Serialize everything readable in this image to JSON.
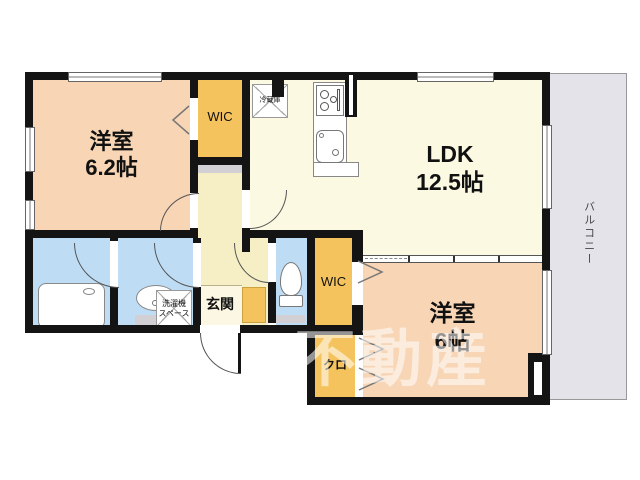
{
  "colors": {
    "wall": "#141414",
    "room-peach": "#f7d5b5",
    "room-orange": "#f5c35e",
    "room-cream": "#fbf9e2",
    "room-pale": "#f6efc6",
    "room-genkan": "#fbf7e3",
    "room-blue": "#bedcf3",
    "balcony-gray": "#e4e3ea",
    "shelf-gray": "#d2cfd5"
  },
  "labels": {
    "bedroom1": {
      "name": "洋室",
      "size": "6.2帖"
    },
    "ldk": {
      "name": "LDK",
      "size": "12.5帖"
    },
    "bedroom2": {
      "name": "洋室",
      "size": "6帖"
    },
    "wic1": "WIC",
    "wic2": "WIC",
    "closet": "クロ",
    "entrance": "玄関",
    "balcony": "バルコニー",
    "laundry_line1": "洗濯機",
    "laundry_line2": "スペース",
    "refrigerator": "冷蔵庫",
    "watermark": "不動産"
  }
}
